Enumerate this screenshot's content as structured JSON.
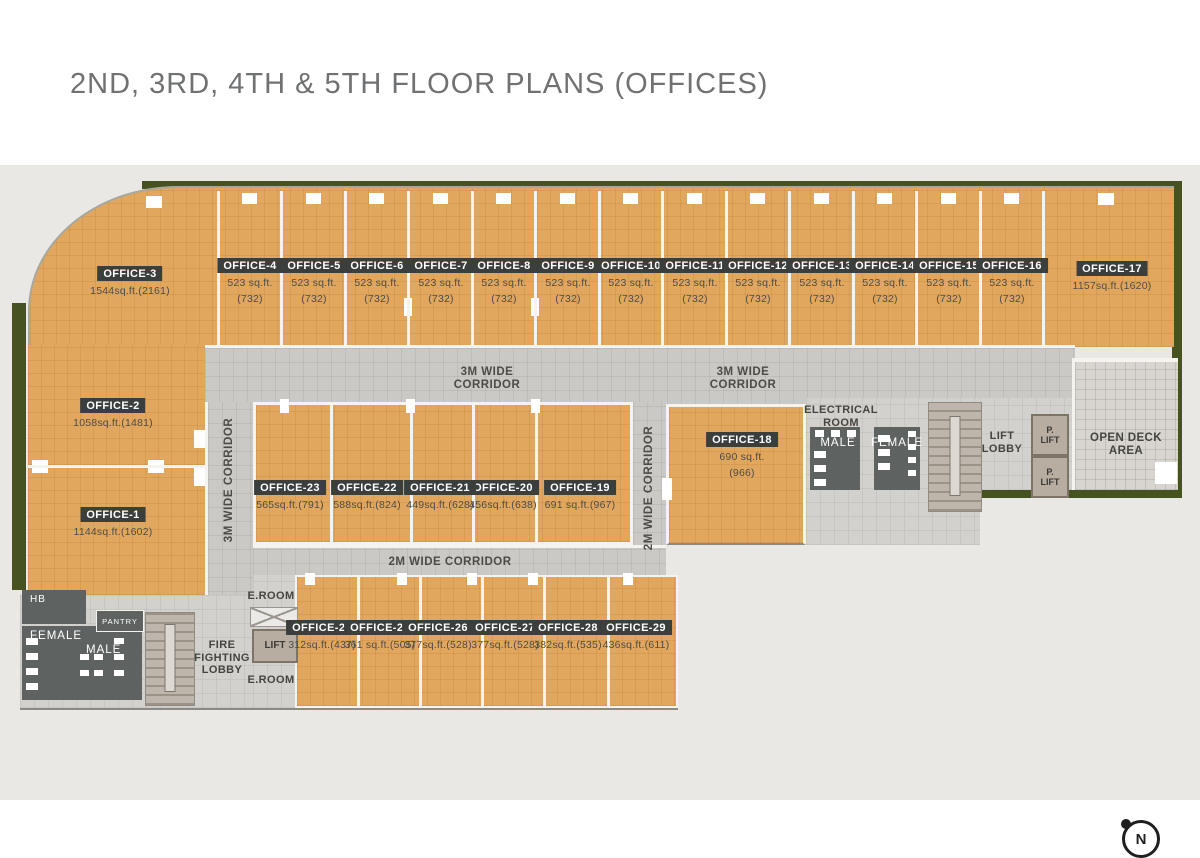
{
  "title": "2ND, 3RD, 4TH & 5TH FLOOR PLANS (OFFICES)",
  "offices": [
    {
      "id": "office-1",
      "label": "OFFICE-1",
      "area": [
        "1144sq.ft.(1602)"
      ]
    },
    {
      "id": "office-2",
      "label": "OFFICE-2",
      "area": [
        "1058sq.ft.(1481)"
      ]
    },
    {
      "id": "office-3",
      "label": "OFFICE-3",
      "area": [
        "1544sq.ft.(2161)"
      ]
    },
    {
      "id": "office-4",
      "label": "OFFICE-4",
      "area": [
        "523 sq.ft.",
        "(732)"
      ]
    },
    {
      "id": "office-5",
      "label": "OFFICE-5",
      "area": [
        "523 sq.ft.",
        "(732)"
      ]
    },
    {
      "id": "office-6",
      "label": "OFFICE-6",
      "area": [
        "523 sq.ft.",
        "(732)"
      ]
    },
    {
      "id": "office-7",
      "label": "OFFICE-7",
      "area": [
        "523 sq.ft.",
        "(732)"
      ]
    },
    {
      "id": "office-8",
      "label": "OFFICE-8",
      "area": [
        "523 sq.ft.",
        "(732)"
      ]
    },
    {
      "id": "office-9",
      "label": "OFFICE-9",
      "area": [
        "523 sq.ft.",
        "(732)"
      ]
    },
    {
      "id": "office-10",
      "label": "OFFICE-10",
      "area": [
        "523 sq.ft.",
        "(732)"
      ]
    },
    {
      "id": "office-11",
      "label": "OFFICE-11",
      "area": [
        "523 sq.ft.",
        "(732)"
      ]
    },
    {
      "id": "office-12",
      "label": "OFFICE-12",
      "area": [
        "523 sq.ft.",
        "(732)"
      ]
    },
    {
      "id": "office-13",
      "label": "OFFICE-13",
      "area": [
        "523 sq.ft.",
        "(732)"
      ]
    },
    {
      "id": "office-14",
      "label": "OFFICE-14",
      "area": [
        "523 sq.ft.",
        "(732)"
      ]
    },
    {
      "id": "office-15",
      "label": "OFFICE-15",
      "area": [
        "523 sq.ft.",
        "(732)"
      ]
    },
    {
      "id": "office-16",
      "label": "OFFICE-16",
      "area": [
        "523 sq.ft.",
        "(732)"
      ]
    },
    {
      "id": "office-17",
      "label": "OFFICE-17",
      "area": [
        "1157sq.ft.(1620)"
      ]
    },
    {
      "id": "office-18",
      "label": "OFFICE-18",
      "area": [
        "690 sq.ft.",
        "(966)"
      ]
    },
    {
      "id": "office-19",
      "label": "OFFICE-19",
      "area": [
        "691 sq.ft.(967)"
      ]
    },
    {
      "id": "office-20",
      "label": "OFFICE-20",
      "area": [
        "456sq.ft.(638)"
      ]
    },
    {
      "id": "office-21",
      "label": "OFFICE-21",
      "area": [
        "449sq.ft.(628)"
      ]
    },
    {
      "id": "office-22",
      "label": "OFFICE-22",
      "area": [
        "588sq.ft.(824)"
      ]
    },
    {
      "id": "office-23",
      "label": "OFFICE-23",
      "area": [
        "565sq.ft.(791)"
      ]
    },
    {
      "id": "office-24",
      "label": "OFFICE-24",
      "area": [
        "312sq.ft.(437)"
      ]
    },
    {
      "id": "office-25",
      "label": "OFFICE-25",
      "area": [
        "361 sq.ft.(505)"
      ]
    },
    {
      "id": "office-26",
      "label": "OFFICE-26",
      "area": [
        "377sq.ft.(528)"
      ]
    },
    {
      "id": "office-27",
      "label": "OFFICE-27",
      "area": [
        "377sq.ft.(528)"
      ]
    },
    {
      "id": "office-28",
      "label": "OFFICE-28",
      "area": [
        "382sq.ft.(535)"
      ]
    },
    {
      "id": "office-29",
      "label": "OFFICE-29",
      "area": [
        "436sq.ft.(611)"
      ]
    }
  ],
  "corridors": {
    "h3m_left": "3M WIDE\nCORRIDOR",
    "h3m_right": "3M WIDE\nCORRIDOR",
    "v3m": "3M WIDE CORRIDOR",
    "v2m": "2M WIDE CORRIDOR",
    "h2m": "2M WIDE CORRIDOR"
  },
  "rooms": {
    "electrical": "ELECTRICAL\nROOM",
    "male_right": "MALE",
    "female_right": "FEMALE",
    "lift_lobby": "LIFT\nLOBBY",
    "p_lift_1": "P.\nLIFT",
    "p_lift_2": "P.\nLIFT",
    "open_deck": "OPEN DECK AREA",
    "hb": "HB",
    "female_left": "FEMALE",
    "male_left": "MALE",
    "pantry": "PANTRY",
    "fire_lobby": "FIRE\nFIGHTING\nLOBBY",
    "lift_left": "LIFT",
    "e_room_top": "E.ROOM",
    "e_room_bottom": "E.ROOM"
  },
  "compass": {
    "label": "N"
  },
  "colors": {
    "office_fill": "#e2a75e",
    "corridor": "#cbc9c5",
    "dark_room": "#5e6361",
    "label_chip": "#3a3e3d",
    "hedge_green": "#46521f",
    "plan_background": "#e9e8e5",
    "title_text": "#6f7173"
  }
}
